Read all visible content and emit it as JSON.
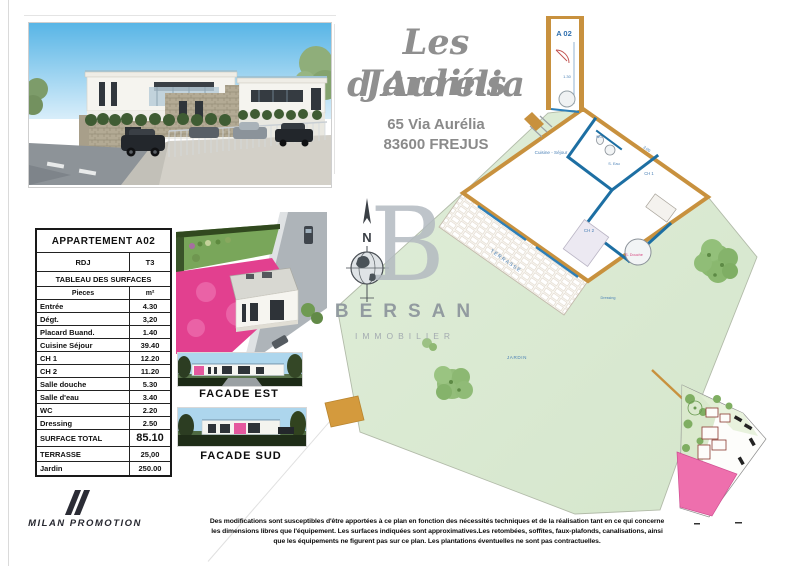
{
  "header": {
    "title_line1": "Les Jardins",
    "title_line2": "d'Aurélia",
    "address_line1": "65 Via Aurélia",
    "address_line2": "83600 FREJUS"
  },
  "surfaces_table": {
    "title": "APPARTEMENT A02",
    "level": "RDJ",
    "type": "T3",
    "section_title": "TABLEAU DES SURFACES",
    "col_room": "Pieces",
    "col_area": "m²",
    "rows": [
      {
        "label": "Entrée",
        "value": "4.30"
      },
      {
        "label": "Dégt.",
        "value": "3,20"
      },
      {
        "label": "Placard Buand.",
        "value": "1.40"
      },
      {
        "label": "Cuisine Séjour",
        "value": "39.40"
      },
      {
        "label": "CH 1",
        "value": "12.20"
      },
      {
        "label": "CH 2",
        "value": "11.20"
      },
      {
        "label": "Salle douche",
        "value": "5.30"
      },
      {
        "label": "Salle d'eau",
        "value": "3.40"
      },
      {
        "label": "WC",
        "value": "2.20"
      },
      {
        "label": "Dressing",
        "value": "2.50"
      }
    ],
    "total": {
      "label": "SURFACE TOTAL",
      "value": "85.10"
    },
    "terrace": {
      "label": "TERRASSE",
      "value": "25,00"
    },
    "garden": {
      "label": "Jardin",
      "value": "250.00"
    }
  },
  "renders": {
    "facade_est_label": "FACADE EST",
    "facade_sud_label": "FACADE SUD"
  },
  "watermark": {
    "initial": "B",
    "brand": "BERSAN",
    "subtitle": "IMMOBILIER",
    "compass_north": "N"
  },
  "floor_plan": {
    "unit": "A 02",
    "labels": {
      "sejour": "Cuisine - Séjour",
      "terrasse": "TERRASSE",
      "jardin": "JARDIN",
      "ch1": "CH 1",
      "ch2": "CH 2",
      "douche": "S. Douche",
      "eau": "S. Eau",
      "wc": "WC",
      "dressing": "Dressing"
    },
    "dims": {
      "entry": "1.30",
      "wall": "3.00"
    }
  },
  "footer": {
    "disclaimer_line1": "Des modifications sont susceptibles d'être apportées à ce plan en fonction des nécessités techniques et de la réalisation tant en ce qui concerne",
    "disclaimer_line2": "les dimensions libres que l'équipement.  Les surfaces indiquées sont approximatives.Les retombées, soffites, faux-plafonds, canalisations, ainsi",
    "disclaimer_line3": "que les équipements ne figurent pas sur ce plan. Les plantations éventuelles ne sont pas contractuelles.",
    "developer": "MILAN PROMOTION"
  },
  "colors": {
    "accent_pink": "#ec5fa3",
    "wall_tan": "#c8913e",
    "wall_blue": "#1d6fa3",
    "garden_green": "#dcead5",
    "title_gray": "#8f8f8f"
  }
}
